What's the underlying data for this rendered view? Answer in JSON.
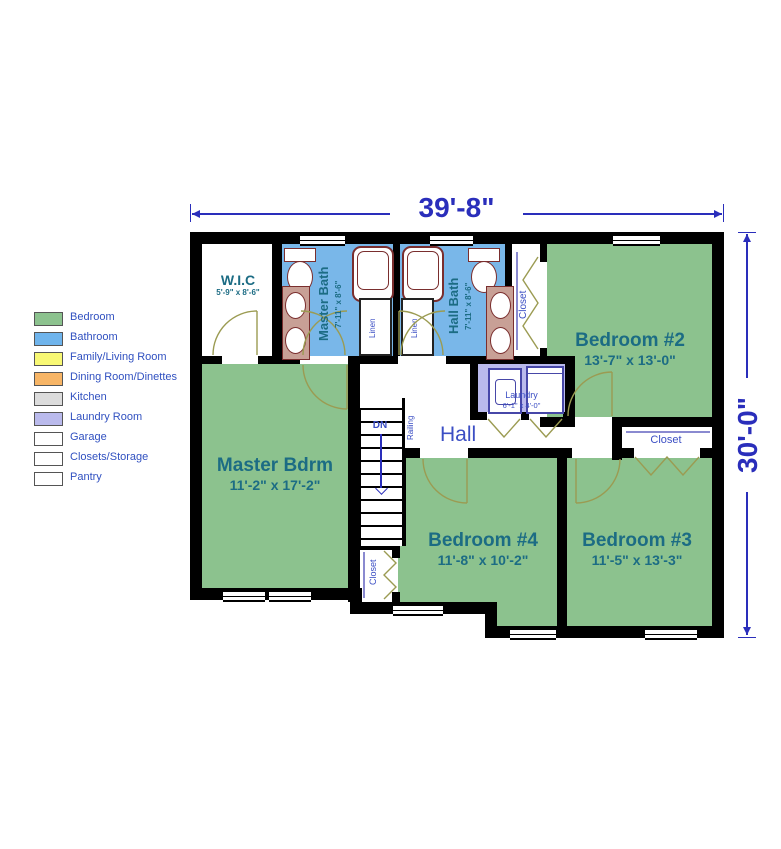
{
  "dimensions": {
    "width_label": "39'-8\"",
    "height_label": "30'-0\""
  },
  "legend": {
    "items": [
      {
        "label": "Bedroom",
        "color": "#8cc28e"
      },
      {
        "label": "Bathroom",
        "color": "#6fb4ec"
      },
      {
        "label": "Family/Living Room",
        "color": "#f8f874"
      },
      {
        "label": "Dining Room/Dinettes",
        "color": "#f7b566"
      },
      {
        "label": "Kitchen",
        "color": "#dcdcdc"
      },
      {
        "label": "Laundry Room",
        "color": "#babaec"
      },
      {
        "label": "Garage",
        "color": "#ffffff"
      },
      {
        "label": "Closets/Storage",
        "color": "#ffffff"
      },
      {
        "label": "Pantry",
        "color": "#ffffff"
      }
    ]
  },
  "rooms": {
    "wic": {
      "name": "W.I.C",
      "size": "5'-9\" x 8'-6\""
    },
    "master_bath": {
      "name": "Master Bath",
      "size": "7'-11\" x 8'-6\""
    },
    "hall_bath": {
      "name": "Hall Bath",
      "size": "7'-11\" x 8'-6\""
    },
    "bedroom2": {
      "name": "Bedroom #2",
      "size": "13'-7\" x 13'-0\""
    },
    "master_bdrm": {
      "name": "Master Bdrm",
      "size": "11'-2\" x 17'-2\""
    },
    "bedroom4": {
      "name": "Bedroom #4",
      "size": "11'-8\" x 10'-2\""
    },
    "bedroom3": {
      "name": "Bedroom #3",
      "size": "11'-5\" x 13'-3\""
    },
    "laundry": {
      "name": "Laundry",
      "size": "6'-1\" x 4'-0\""
    },
    "hall": {
      "name": "Hall"
    }
  },
  "labels": {
    "closet": "Closet",
    "linen": "Linen",
    "down": "DN",
    "railing": "Railing"
  },
  "colors": {
    "wall": "#000000",
    "bedroom": "#8cc28e",
    "bathroom": "#79b7e9",
    "laundry": "#babaec",
    "door_arc": "#9b9b52",
    "fixture_outline": "#7a2e2e",
    "room_label": "#1c6c84",
    "small_label": "#3b4ec4",
    "dimension_text": "#2a2ebb"
  }
}
